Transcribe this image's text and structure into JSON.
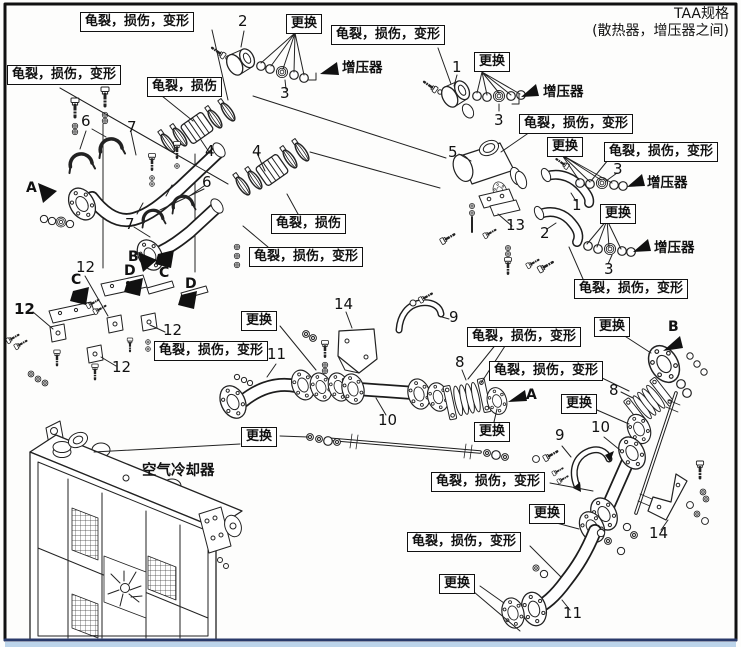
{
  "title": {
    "line1": "TAA规格",
    "line2": "(散热器，增压器之间)"
  },
  "strings": {
    "crack_damage_deform": "龟裂，损伤，变形",
    "crack_damage": "龟裂，损伤",
    "replace": "更换",
    "turbocharger": "增压器",
    "air_cooler": "空气冷却器"
  },
  "part_numbers": {
    "n1": "1",
    "n2": "2",
    "n3": "3",
    "n4": "4",
    "n5": "5",
    "n6": "6",
    "n7": "7",
    "n8": "8",
    "n9": "9",
    "n10": "10",
    "n11": "11",
    "n12": "12",
    "n13": "13",
    "n14": "14"
  },
  "ref_letters": {
    "a": "A",
    "b": "B",
    "c": "C",
    "d": "D"
  }
}
